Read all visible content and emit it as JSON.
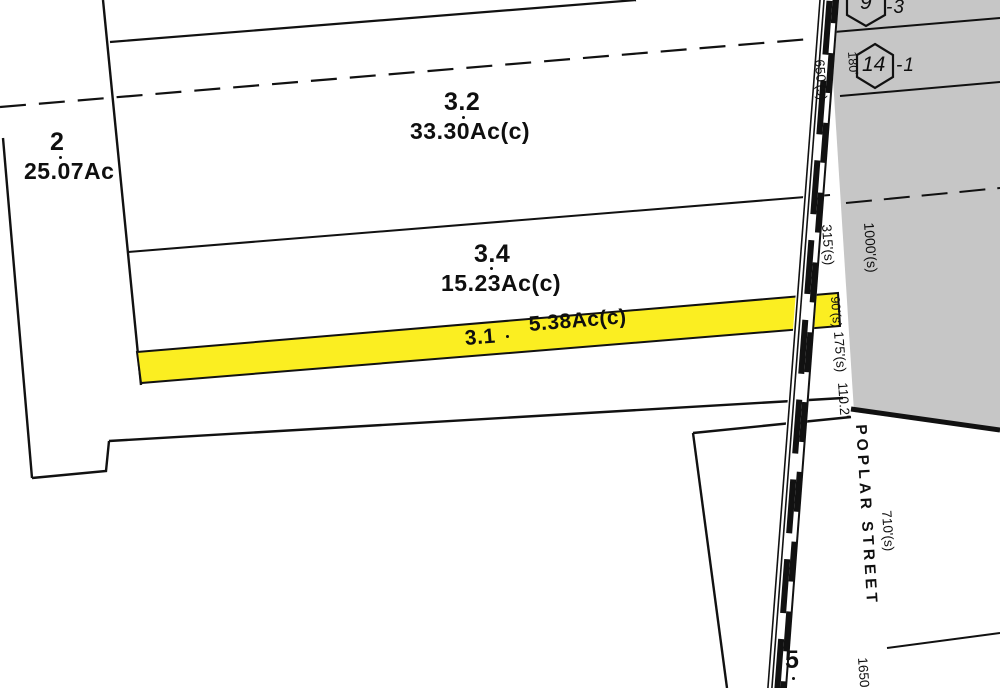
{
  "street": {
    "name": "POPLAR STREET"
  },
  "parcels": {
    "p2": {
      "id": "2",
      "area": "25.07Ac"
    },
    "p3_2": {
      "id": "3.2",
      "area": "33.30Ac(c)"
    },
    "p3_4": {
      "id": "3.4",
      "area": "15.23Ac(c)"
    },
    "p3_1": {
      "id": "3.1",
      "area": "5.38Ac(c)"
    },
    "p5": {
      "id": "5"
    }
  },
  "hex_markers": {
    "m9": {
      "number": "9",
      "suffix": "-3"
    },
    "m14": {
      "number": "14",
      "suffix": "-1"
    }
  },
  "dimensions": {
    "d650": "650'(s)",
    "d315": "315'(s)",
    "d90": "90'(s)",
    "d175": "175'(s)",
    "d110": "110.2'",
    "d1000": "1000'(s)",
    "d710": "710'(s)",
    "d1650": "1650",
    "d180": "180'"
  },
  "colors": {
    "highlight_yellow": "#fbee21",
    "shaded_gray": "#c6c6c6",
    "line_black": "#111111"
  }
}
